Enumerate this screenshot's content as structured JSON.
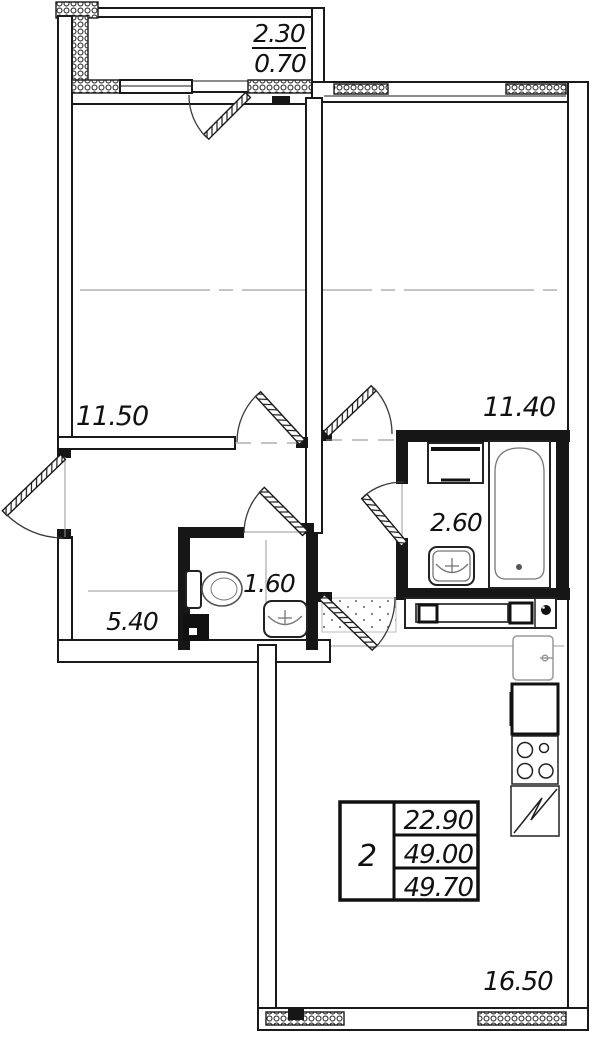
{
  "plan": {
    "title": "2-room apartment floor plan",
    "balcony": {
      "area_top": "2.30",
      "area_bottom": "0.70"
    },
    "rooms": [
      {
        "id": "bedroom-left",
        "label": "11.50"
      },
      {
        "id": "bedroom-right",
        "label": "11.40"
      },
      {
        "id": "bathroom",
        "label": "2.60"
      },
      {
        "id": "wc",
        "label": "1.60"
      },
      {
        "id": "hallway",
        "label": "5.40"
      },
      {
        "id": "kitchen-living",
        "label": "16.50"
      }
    ],
    "summary_table": {
      "rooms_count": "2",
      "living_area": "22.90",
      "area": "49.00",
      "total_area": "49.70"
    },
    "colors": {
      "line": "#1a1a1a",
      "fixture": "#777777",
      "light_line": "#9a9a9a",
      "background": "#ffffff"
    }
  }
}
